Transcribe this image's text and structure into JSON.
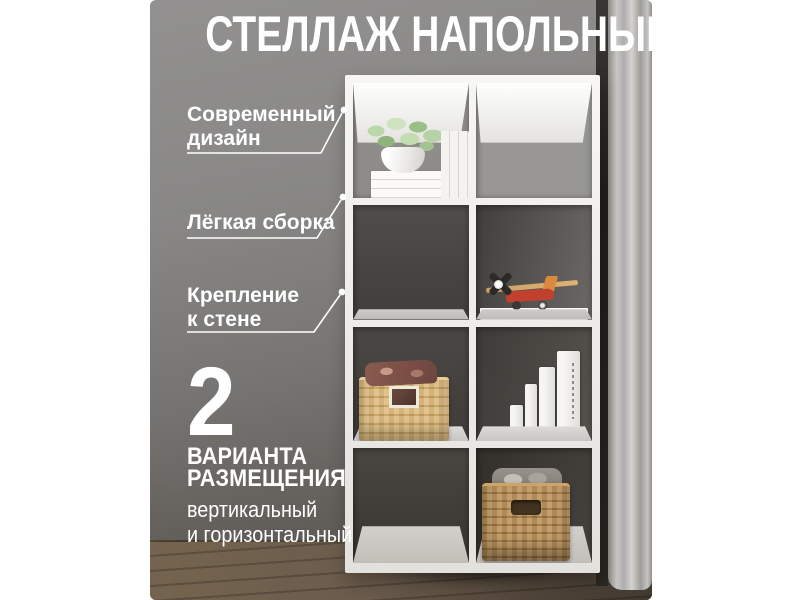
{
  "title": "СТЕЛЛАЖ НАПОЛЬНЫЙ",
  "callouts": [
    {
      "lines": [
        "Современный",
        "дизайн"
      ]
    },
    {
      "lines": [
        "Лёгкая сборка"
      ]
    },
    {
      "lines": [
        "Крепление",
        "к стене"
      ]
    }
  ],
  "placement": {
    "count": "2",
    "title_lines": [
      "ВАРИАНТА",
      "РАЗМЕЩЕНИЯ"
    ],
    "subtitle_lines": [
      "вертикальный",
      "и горизонтальный"
    ]
  },
  "palette": {
    "text": "#ffffff",
    "wall_light": "#949392",
    "wall_dark": "#544f49",
    "shelf_white": "#f2f1ef",
    "floor_wood": "#6a5b4c",
    "basket_light": "#dcba80",
    "basket_dark": "#b78d56",
    "plant_green": "#aecb9c",
    "toy_red": "#c2402f",
    "curtain": "#c0bebb"
  }
}
